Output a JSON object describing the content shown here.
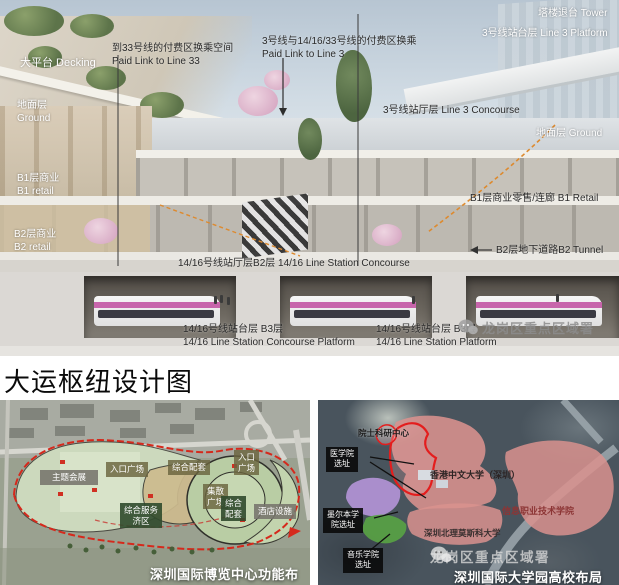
{
  "title": "大运枢纽设计图",
  "hero": {
    "watermark": "龙岗区重点区域署",
    "labels": {
      "decking": "大平台 Decking",
      "link33": "到33号线的付费区换乘空间\nPaid Link to Line 33",
      "link3": "3号线与14/16/33号线的付费区换乘\nPaid Link to Line 3",
      "tower": "塔楼退台 Tower",
      "line3_platform": "3号线站台层 Line 3 Platform",
      "line3_concourse": "3号线站厅层 Line 3 Concourse",
      "ground_left": "地面层\nGround",
      "ground_right": "地面层 Ground",
      "b1_left": "B1层商业\nB1 retail",
      "b1_right": "B1层商业零售/连廊 B1 Retail",
      "b2_left": "B2层商业\nB2 retail",
      "b2_tunnel": "B2层地下道路B2 Tunnel",
      "line1416_concourse": "14/16号线站厅层B2层 14/16 Line Station Concourse",
      "b3_left": "14/16号线站台层 B3层\n14/16 Line Station Concourse Platform",
      "b3_right": "14/16号线站台层 B3层\n14/16 Line Station Platform"
    }
  },
  "expo_map": {
    "caption": "深圳国际博览中心功能布局",
    "zones": {
      "theme": "主题会展",
      "entrance": "入口广场",
      "support1": "综合配套",
      "entrance2": "入口\n广场",
      "plaza": "集散\n广场",
      "support2": "综合\n配套",
      "hotel": "酒店设施",
      "service": "综合服务\n济区"
    }
  },
  "uni_map": {
    "caption": "深圳国际大学园高校布局",
    "watermark": "龙岗区重点区域署",
    "labels": {
      "research": "院士科研中心",
      "medical": "医学院\n选址",
      "cuhk": "香港中文大学（深圳）",
      "info": "信息职业技术学院",
      "melbourne": "墨尔本学\n院选址",
      "msu": "深圳北理莫斯科大学",
      "music": "音乐学院\n选址"
    }
  },
  "colors": {
    "accent_red": "#d5291c",
    "magenta_train": "#c765ab",
    "pink_zone": "#d9928e",
    "purple_zone": "#b595d8",
    "green_zone": "#58a244"
  }
}
